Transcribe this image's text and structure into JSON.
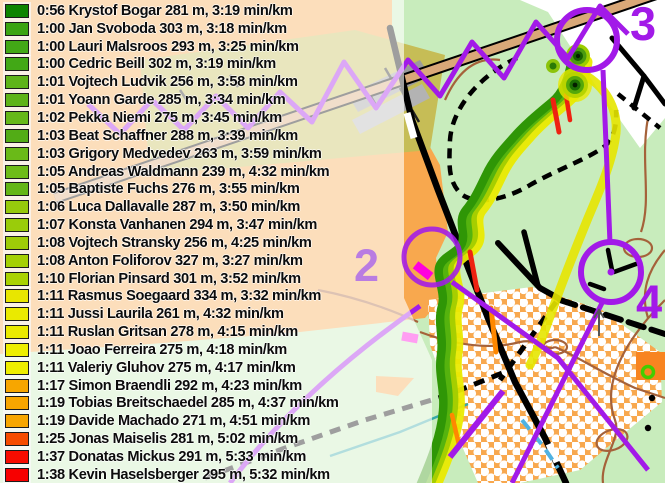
{
  "legend_rows": [
    {
      "time": "0:56",
      "name": "Krystof Bogar",
      "distance": "281 m",
      "pace": "3:19 min/km",
      "color": "#0d8400"
    },
    {
      "time": "1:00",
      "name": "Jan Svoboda",
      "distance": "303 m",
      "pace": "3:18 min/km",
      "color": "#3ba412"
    },
    {
      "time": "1:00",
      "name": "Lauri Malsroos",
      "distance": "293 m",
      "pace": "3:25 min/km",
      "color": "#42a816"
    },
    {
      "time": "1:00",
      "name": "Cedric Beill",
      "distance": "302 m",
      "pace": "3:19 min/km",
      "color": "#42a816"
    },
    {
      "time": "1:01",
      "name": "Vojtech Ludvik",
      "distance": "256 m",
      "pace": "3:58 min/km",
      "color": "#5eb41a"
    },
    {
      "time": "1:01",
      "name": "Yoann Garde",
      "distance": "285 m",
      "pace": "3:34 min/km",
      "color": "#5eb41a"
    },
    {
      "time": "1:02",
      "name": "Pekka Niemi",
      "distance": "275 m",
      "pace": "3:45 min/km",
      "color": "#66b81a"
    },
    {
      "time": "1:03",
      "name": "Beat Schaffner",
      "distance": "288 m",
      "pace": "3:39 min/km",
      "color": "#52ac16"
    },
    {
      "time": "1:03",
      "name": "Grigory Medvedev",
      "distance": "263 m",
      "pace": "3:59 min/km",
      "color": "#6aba18"
    },
    {
      "time": "1:05",
      "name": "Andreas Waldmann",
      "distance": "239 m",
      "pace": "4:32 min/km",
      "color": "#6ebc18"
    },
    {
      "time": "1:05",
      "name": "Baptiste Fuchs",
      "distance": "276 m",
      "pace": "3:55 min/km",
      "color": "#64b616"
    },
    {
      "time": "1:06",
      "name": "Luca Dallavalle",
      "distance": "287 m",
      "pace": "3:50 min/km",
      "color": "#96ca0c"
    },
    {
      "time": "1:07",
      "name": "Konsta Vanhanen",
      "distance": "294 m",
      "pace": "3:47 min/km",
      "color": "#9acc0a"
    },
    {
      "time": "1:08",
      "name": "Vojtech Stransky",
      "distance": "256 m",
      "pace": "4:25 min/km",
      "color": "#9ecc08"
    },
    {
      "time": "1:08",
      "name": "Anton Foliforov",
      "distance": "327 m",
      "pace": "3:27 min/km",
      "color": "#a4d004"
    },
    {
      "time": "1:10",
      "name": "Florian Pinsard",
      "distance": "301 m",
      "pace": "3:52 min/km",
      "color": "#aad202"
    },
    {
      "time": "1:11",
      "name": "Rasmus Soegaard",
      "distance": "334 m",
      "pace": "3:32 min/km",
      "color": "#e8e600"
    },
    {
      "time": "1:11",
      "name": "Jussi Laurila",
      "distance": "261 m",
      "pace": "4:32 min/km",
      "color": "#eaea00"
    },
    {
      "time": "1:11",
      "name": "Ruslan Gritsan",
      "distance": "278 m",
      "pace": "4:15 min/km",
      "color": "#eaea00"
    },
    {
      "time": "1:11",
      "name": "Joao Ferreira",
      "distance": "275 m",
      "pace": "4:18 min/km",
      "color": "#eeee00"
    },
    {
      "time": "1:11",
      "name": "Valeriy Gluhov",
      "distance": "275 m",
      "pace": "4:17 min/km",
      "color": "#eeee00"
    },
    {
      "time": "1:17",
      "name": "Simon Braendli",
      "distance": "292 m",
      "pace": "4:23 min/km",
      "color": "#f7a600"
    },
    {
      "time": "1:19",
      "name": "Tobias Breitschaedel",
      "distance": "285 m",
      "pace": "4:37 min/km",
      "color": "#f7a600"
    },
    {
      "time": "1:19",
      "name": "Davide Machado",
      "distance": "271 m",
      "pace": "4:51 min/km",
      "color": "#f7a600"
    },
    {
      "time": "1:25",
      "name": "Jonas Maiselis",
      "distance": "281 m",
      "pace": "5:02 min/km",
      "color": "#f64c00"
    },
    {
      "time": "1:37",
      "name": "Donatas Mickus",
      "distance": "291 m",
      "pace": "5:33 min/km",
      "color": "#f70c00"
    },
    {
      "time": "1:38",
      "name": "Kevin Haselsberger",
      "distance": "295 m",
      "pace": "5:32 min/km",
      "color": "#f70000"
    }
  ],
  "map": {
    "controls": {
      "c2": "2",
      "c3": "3",
      "c4": "4"
    },
    "colors": {
      "course_purple": "#a21ae8",
      "gps_fast": "#2f9606",
      "gps_medium": "#a6ce00",
      "gps_slow": "#eaea00",
      "gps_stopped": "#ee2211",
      "map_open_green": "#c8ecbc",
      "map_rough_orange": "#f8a84e"
    }
  }
}
